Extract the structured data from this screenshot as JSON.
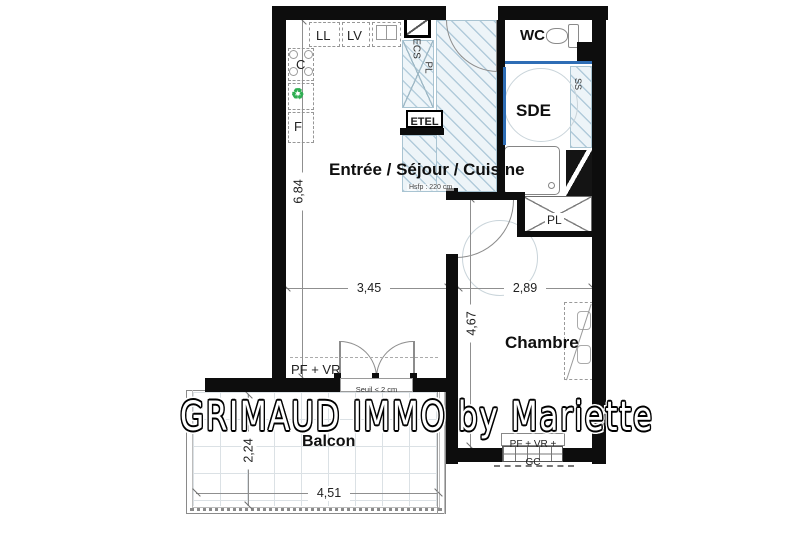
{
  "watermark": {
    "text": "GRIMAUD IMMO by Mariette"
  },
  "rooms": {
    "main": {
      "label": "Entrée / Séjour / Cuisine",
      "ceiling_note": "Hsfp : 220 cm"
    },
    "wc": {
      "label": "WC"
    },
    "sde": {
      "label": "SDE"
    },
    "chambre": {
      "label": "Chambre"
    },
    "balcon": {
      "label": "Balcon"
    }
  },
  "fixtures": {
    "washing_machine": "LL",
    "dishwasher": "LV",
    "cooktop": "C",
    "fridge": "F",
    "water_heater": "ECS",
    "hall_closet": "PL",
    "bedroom_closet": "PL",
    "technical_panel": "ETEL",
    "towel_rail": "SS",
    "recycle_symbol": "♻"
  },
  "openings": {
    "living_window": "PF + VR",
    "threshold_note": "Seuil < 2 cm",
    "bedroom_window": "PF + VR + GC"
  },
  "dimensions": {
    "living_length": "6,84",
    "living_width": "3,45",
    "bedroom_width": "2,89",
    "bedroom_length": "4,67",
    "balcony_depth": "2,24",
    "balcony_width": "4,51"
  },
  "colors": {
    "wall": "#0d0d0d",
    "hatch_line": "#a9c4d2",
    "hatch_bg": "#edf4f8",
    "door_blue": "#2e6db5",
    "recycle_green": "#2fae52"
  }
}
